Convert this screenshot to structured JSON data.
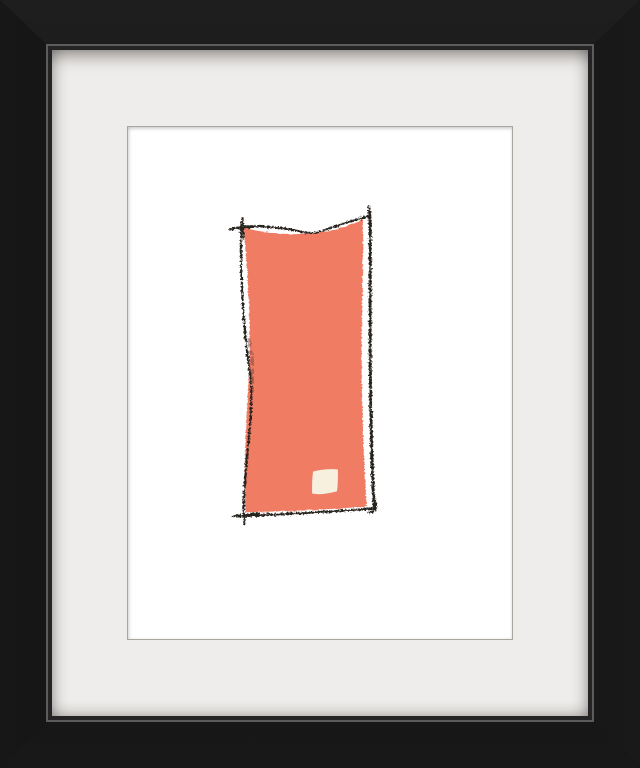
{
  "framed_print": {
    "subject": "abstract painting of a tall coral block with a hand-drawn charcoal outline and a small cream square near its lower right",
    "frame": {
      "style": "black wood gallery frame with mitered corners",
      "mat": "white mat board",
      "colors": {
        "frame_black": "#111111",
        "lip_gray": "#5c5c5c",
        "mat_white": "#efedeb",
        "paper_white": "#ffffff"
      }
    },
    "artwork": {
      "colors": {
        "coral": "#ef7c64",
        "charcoal": "#28211e",
        "smudge": "#6b4038",
        "cream_patch": "#f7f0de"
      }
    }
  }
}
